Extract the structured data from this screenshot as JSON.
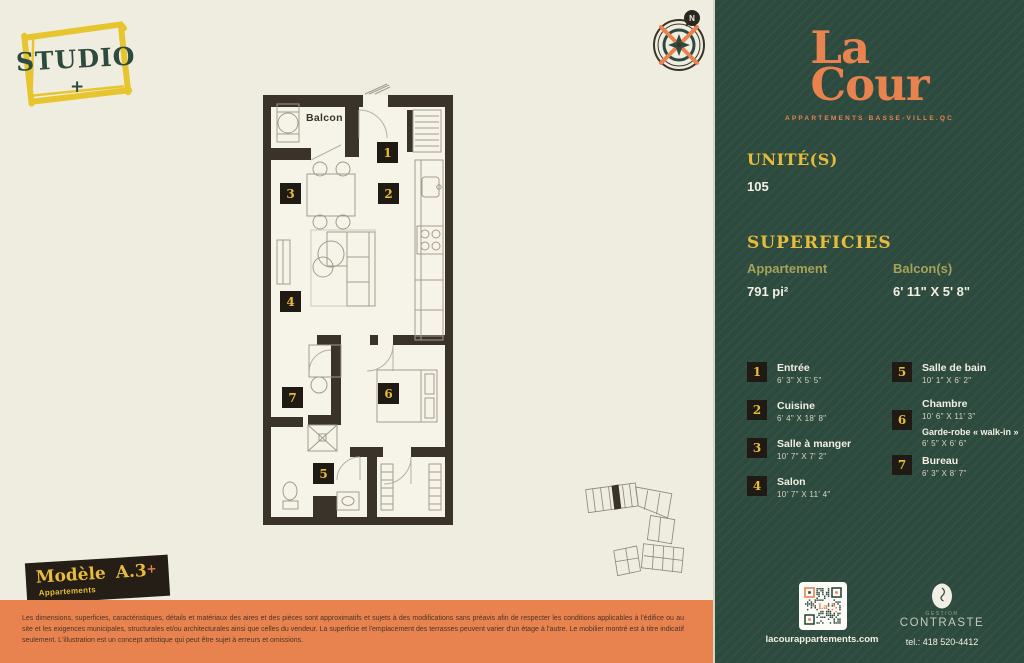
{
  "studio_badge": {
    "label": "STUDIO",
    "plus": "+"
  },
  "compass": {
    "north_label": "N"
  },
  "floorplan": {
    "balcony_label": "Balcon",
    "tags": [
      "1",
      "2",
      "3",
      "4",
      "5",
      "6",
      "7"
    ]
  },
  "model_badge": {
    "title": "Modèle",
    "code": "A.3",
    "plus": "+",
    "subtitle": "Appartements"
  },
  "disclaimer": "Les dimensions, superficies, caractéristiques, détails et matériaux des aires et des pièces sont approximatifs et sujets à des modifications sans préavis afin de respecter les conditions applicables à l'édifice ou au site et les exigences municipales, structurales et/ou architecturales ainsi que celles du vendeur. La superficie et l'emplacement des terrasses peuvent varier d'un étage à l'autre. Le mobilier montré est à titre indicatif seulement. L'illustration est un concept artistique qui peut être sujet à erreurs et omissions.",
  "sidebar": {
    "brand": {
      "line1": "La",
      "line2": "Cour",
      "tagline": "APPARTEMENTS BASSE-VILLE.QC"
    },
    "unit": {
      "heading": "UNITÉ(S)",
      "value": "105"
    },
    "superficies": {
      "heading": "SUPERFICIES",
      "apartment_label": "Appartement",
      "apartment_value": "791 pi²",
      "balcony_label": "Balcon(s)",
      "balcony_value": "6' 11\" X 5' 8\""
    },
    "legend": {
      "left": [
        {
          "num": "1",
          "name": "Entrée",
          "dims": "6' 3\" X 5' 5\""
        },
        {
          "num": "2",
          "name": "Cuisine",
          "dims": "6' 4\" X 18' 8\""
        },
        {
          "num": "3",
          "name": "Salle à manger",
          "dims": "10' 7\" X 7' 2\""
        },
        {
          "num": "4",
          "name": "Salon",
          "dims": "10' 7\" X 11' 4\""
        }
      ],
      "right": [
        {
          "num": "5",
          "name": "Salle de bain",
          "dims": "10' 1\" X 6' 2\""
        },
        {
          "num": "6",
          "name": "Chambre",
          "dims": "10' 6\" X 11' 3\"",
          "sub_name": "Garde-robe « walk-in »",
          "sub_dims": "6' 5\" X 6' 6\""
        },
        {
          "num": "7",
          "name": "Bureau",
          "dims": "6' 3\" X 8' 7\""
        }
      ]
    },
    "footer": {
      "website": "lacourappartements.com",
      "management_small": "GESTION",
      "management_large": "CONTRASTE",
      "phone": "tel.: 418 520-4412",
      "qr_center": "La"
    }
  },
  "colors": {
    "cream": "#efede0",
    "green": "#2d4a3e",
    "orange": "#e8834f",
    "yellow": "#e7bc3b",
    "olive": "#a6a258",
    "wall": "#3a3329",
    "tag_bg": "#1f1a13"
  }
}
